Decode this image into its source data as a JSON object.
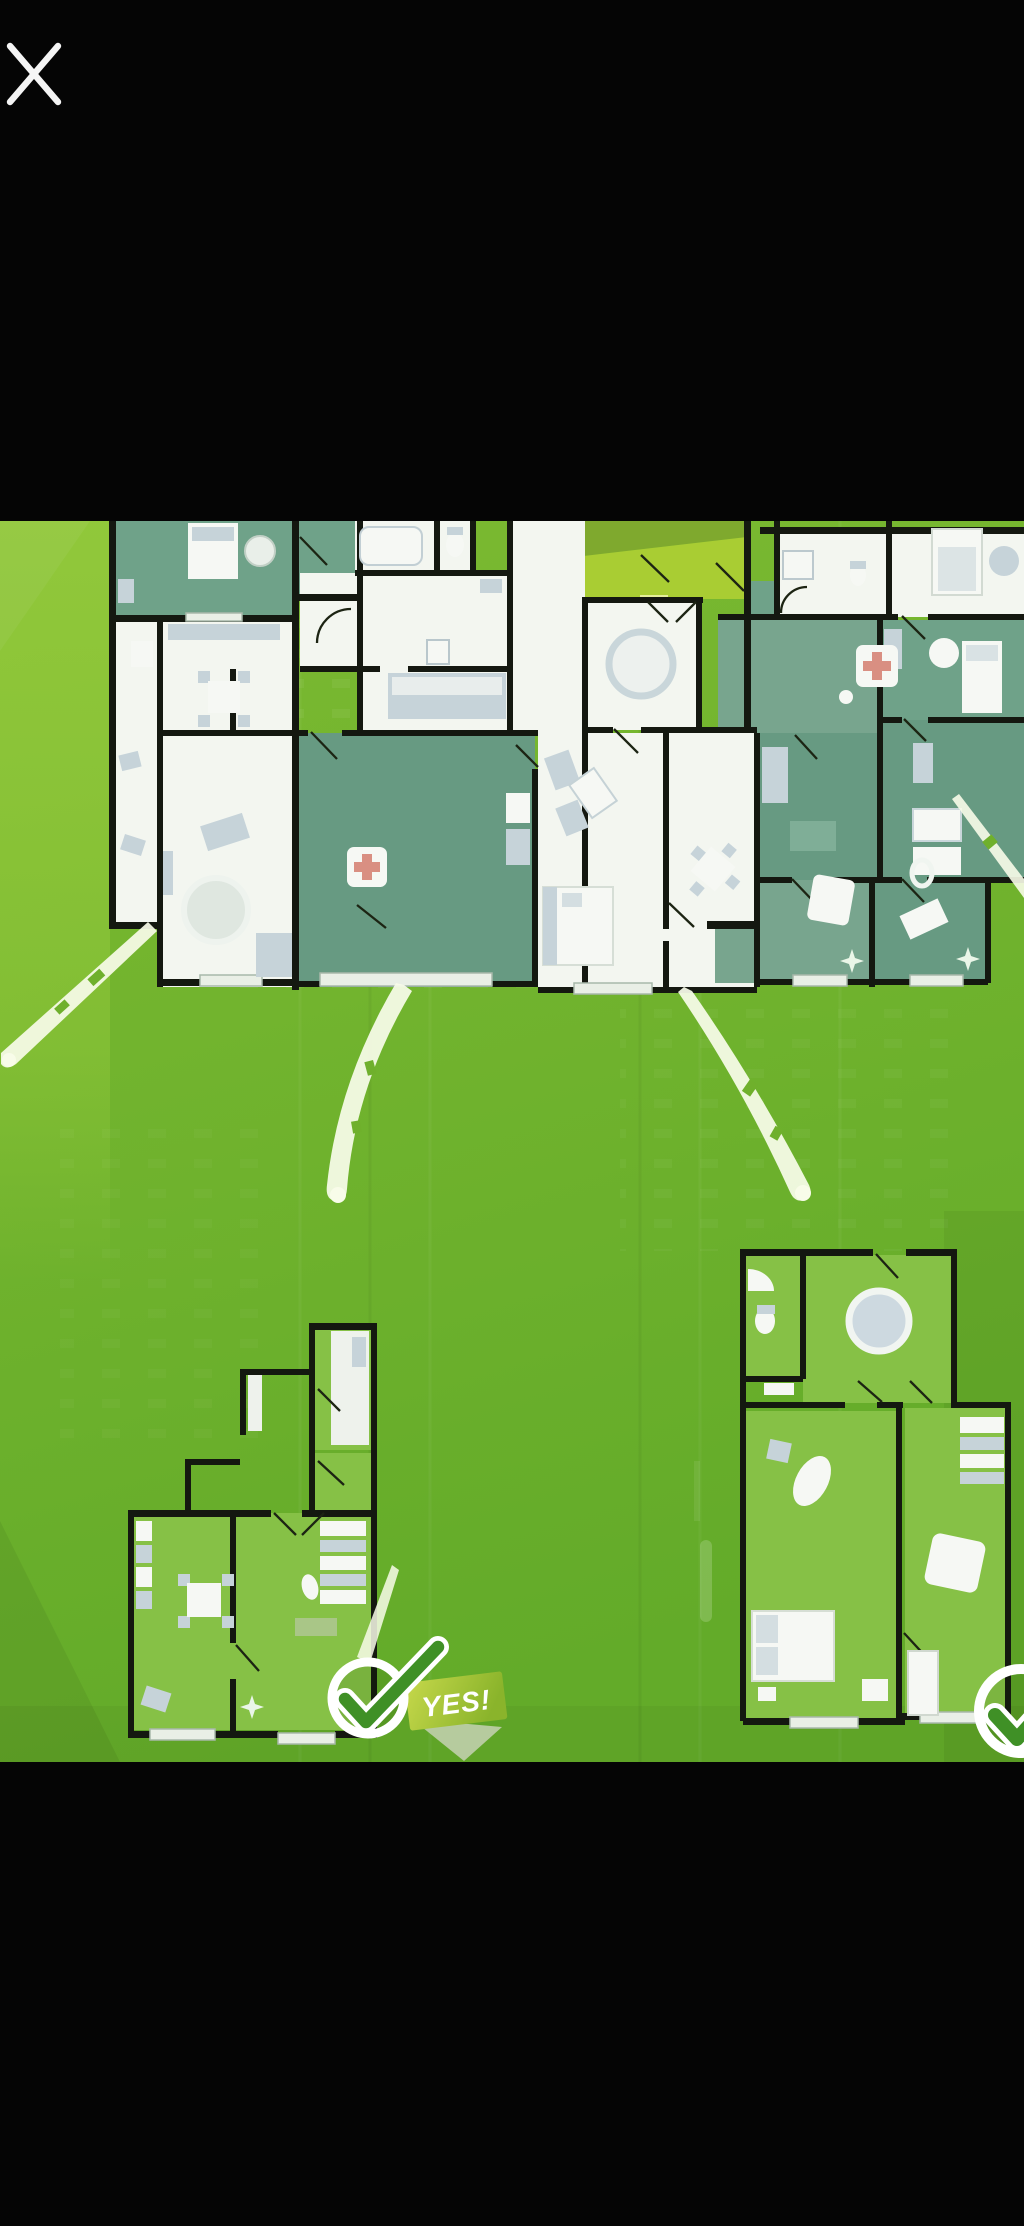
{
  "viewer": {
    "type": "fullscreen-image-preview",
    "background": "#000000",
    "close_icon": "✕"
  },
  "poster": {
    "alt_text": "Green real-estate poster: row of apartment floor plans at top, white motion streaks falling to two detached floor plans below, approval checkmark badges",
    "badge_label": "YES!",
    "palette": {
      "poster_green": "#74b52e",
      "poster_green_light": "#93c93b",
      "lime_highlight": "#a9cd33",
      "olive_strip": "#7fa92e",
      "wall_black": "#141810",
      "room_white": "#f3f6f0",
      "room_sage": "#6fa289",
      "room_sage_dark": "#679a82",
      "plan_floor_green": "#86c146",
      "furniture_gray": "#c6d3d9",
      "streak_white": "#f8fce9",
      "check_green": "#3f9026",
      "ribbon_lime": "#b9d234",
      "badge_ring": "#ffffff"
    }
  }
}
